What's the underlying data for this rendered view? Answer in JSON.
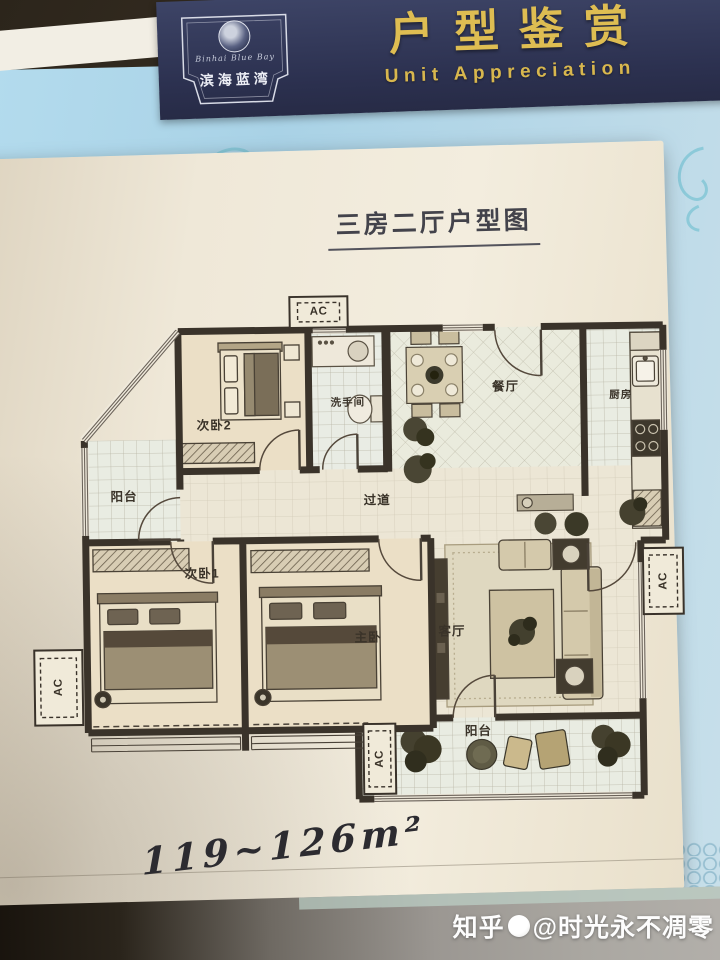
{
  "header": {
    "logo": {
      "script": "Binhai Blue Bay",
      "brand": "滨海蓝湾"
    },
    "title": "户型鉴赏",
    "subtitle": "Unit Appreciation"
  },
  "sheet": {
    "plan_title": "三房二厅户型图",
    "area_range": "119~126m²"
  },
  "floorplan": {
    "ac_label": "AC",
    "rooms": [
      {
        "key": "bedroom2",
        "label": "次卧2"
      },
      {
        "key": "bathroom",
        "label": "洗手间"
      },
      {
        "key": "dining",
        "label": "餐厅"
      },
      {
        "key": "kitchen",
        "label": "厨房"
      },
      {
        "key": "hallway",
        "label": "过道"
      },
      {
        "key": "balcony_left",
        "label": "阳台"
      },
      {
        "key": "bedroom1",
        "label": "次卧1"
      },
      {
        "key": "master_bedroom",
        "label": "主卧"
      },
      {
        "key": "living_room",
        "label": "客厅"
      },
      {
        "key": "balcony_bottom",
        "label": "阳台"
      }
    ]
  },
  "watermark": {
    "site": "知乎",
    "handle": "@时光永不凋零"
  },
  "colors": {
    "band_navy": "#2e3452",
    "gold": "#debd52",
    "paper": "#efe8d8",
    "wall": "#3a332a",
    "sky": "#aed3e6"
  }
}
